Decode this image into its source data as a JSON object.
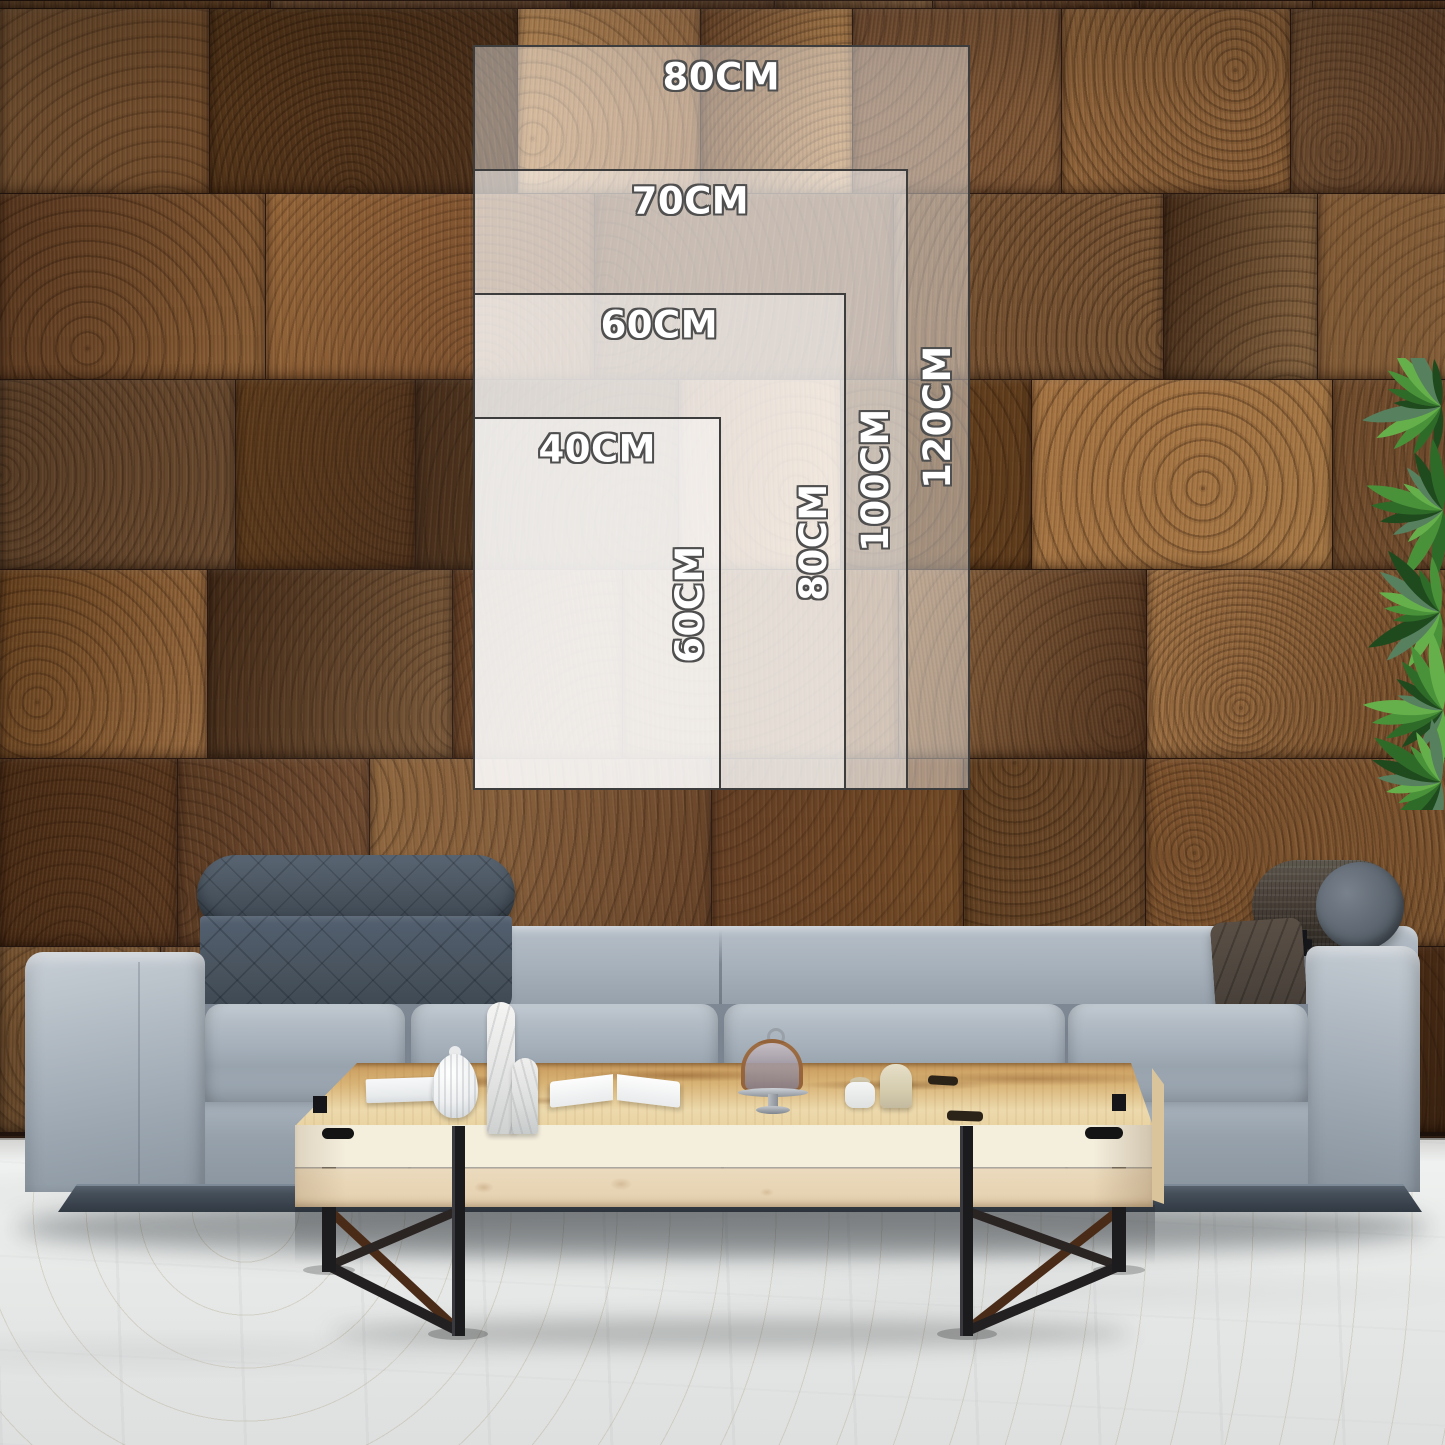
{
  "size_chart": {
    "unit": "CM",
    "px_per_cm": 6.21,
    "anchor": {
      "left_px": 473,
      "bottom_px": 790
    },
    "label_inset_px": 30,
    "style": {
      "fill_rgba": "rgba(255,255,255,0.42)",
      "border_color": "#3d3d3d",
      "border_width_px": 2,
      "label_color": "#ffffff",
      "label_outline_color": "#4f4f4f",
      "label_font_size_px": 37
    },
    "sizes": [
      {
        "width_cm": 80,
        "height_cm": 120,
        "width_label": "80CM",
        "height_label": "120CM"
      },
      {
        "width_cm": 70,
        "height_cm": 100,
        "width_label": "70CM",
        "height_label": "100CM"
      },
      {
        "width_cm": 60,
        "height_cm": 80,
        "width_label": "60CM",
        "height_label": "80CM"
      },
      {
        "width_cm": 40,
        "height_cm": 60,
        "width_label": "40CM",
        "height_label": "60CM"
      }
    ]
  },
  "scene": {
    "colors": {
      "wall_gap": "#2a1810",
      "floor_base": "#e7e9e8",
      "floor_light": "#f1f3f2",
      "floor_dark": "#dee0e0",
      "sofa_light": "#b6bfc8",
      "sofa_mid": "#9fa9b4",
      "sofa_deep": "#7d8894",
      "platform": "#313943",
      "quilt": "#49545f",
      "bolster": "#4a4139",
      "bolster_cap": "#5a636d",
      "pillow": "#4c443d",
      "table_amber": "#c99a5c",
      "table_honey": "#d9b578",
      "table_pale": "#ecd9ac",
      "table_front_upper": "#f4eedd",
      "table_front_lower": "#ebdabd",
      "metal": "#1b1b1d",
      "brace": "#4a2b18",
      "plant_dark": "#1f4a1e",
      "plant_mid": "#2f6b28",
      "plant_bright": "#49923a",
      "plant_light": "#66b04b",
      "plant_gray": "#57805f"
    },
    "wall_palette": [
      "#4a2d17",
      "#5a3820",
      "#6a452a",
      "#7a5433",
      "#8a623c",
      "#996f45",
      "#a97e4f",
      "#55351d",
      "#744e2c",
      "#63401f"
    ]
  }
}
